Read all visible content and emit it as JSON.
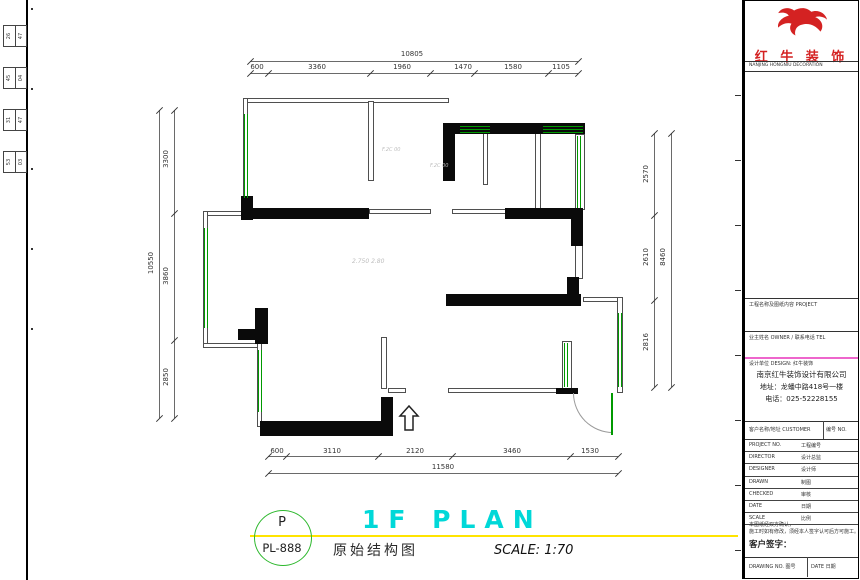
{
  "edge_strip": {
    "boxes": [
      {
        "a": "26",
        "b": "47"
      },
      {
        "a": "45",
        "b": "04"
      },
      {
        "a": "31",
        "b": "47"
      },
      {
        "a": "53",
        "b": "03"
      }
    ]
  },
  "plan": {
    "annotations": {
      "center_level": "2.750 2.80",
      "beam_a": "F.2C 00",
      "beam_b": "F.2C 00"
    },
    "dims": {
      "top": {
        "total": "10805",
        "segments": [
          "600",
          "3360",
          "1960",
          "1470",
          "1580",
          "1105"
        ]
      },
      "bottom": {
        "total": "11580",
        "segments": [
          "600",
          "3110",
          "2120",
          "3460",
          "1530"
        ]
      },
      "left": {
        "total": "10550",
        "segments": [
          "3300",
          "3860",
          "2850"
        ]
      },
      "right": {
        "total": "8460",
        "segments": [
          "2570",
          "2610",
          "2816"
        ]
      }
    }
  },
  "footer": {
    "badge_letter": "P",
    "badge_code": "PL-888",
    "title_en": "1F PLAN",
    "title_cn": "原始结构图",
    "scale": "SCALE: 1:70"
  },
  "title_block": {
    "brand": "红 牛 装 饰",
    "brand_sub": "NANJING HONGNIU DECORATION",
    "section_project": "工程名称及图纸内容 PROJECT",
    "section_owner": "业主姓名 OWNER / 联系电话 TEL",
    "company_caption": "设计单位 DESIGN: 红牛装饰",
    "company_name": "南京红牛装饰设计有限公司",
    "company_address": "地址：龙蟠中路418号一楼",
    "company_phone": "电话：025-52228155",
    "grid_header": {
      "left": "客户名称/地址 CUSTOMER",
      "right": "编号 NO."
    },
    "rows": [
      {
        "en": "PROJECT NO.",
        "cn": "工程编号"
      },
      {
        "en": "DIRECTOR",
        "cn": "设计总监"
      },
      {
        "en": "DESIGNER",
        "cn": "设计师"
      },
      {
        "en": "DRAWN",
        "cn": "制图"
      },
      {
        "en": "CHECKED",
        "cn": "审核"
      },
      {
        "en": "DATE",
        "cn": "日期"
      },
      {
        "en": "SCALE",
        "cn": "比例"
      }
    ],
    "note_line1": "本图纸经双方确认，",
    "note_line2": "施工时如有修改，须经本人签字认可后方可施工。",
    "signature_label": "客户签字：",
    "bottom_row": {
      "left": "DRAWING NO. 图号",
      "right": "DATE 日期"
    }
  },
  "colors": {
    "accent_cyan": "#00d8d8",
    "brand_red": "#d42222",
    "window_green": "#009900",
    "divider_yellow": "#ffe400",
    "divider_pink": "#ee66cc"
  }
}
